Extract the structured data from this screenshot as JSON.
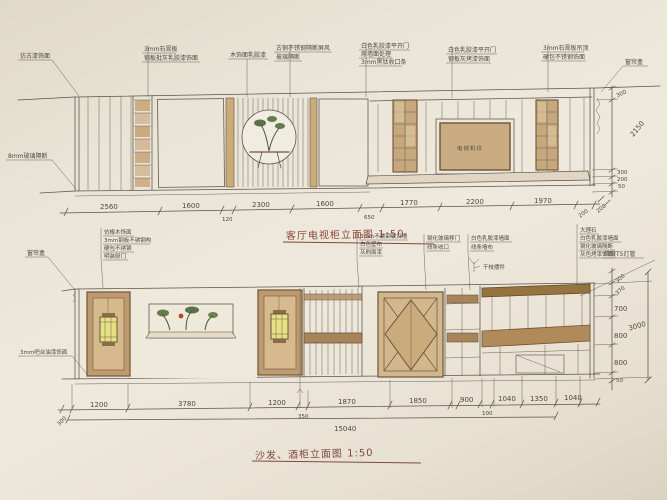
{
  "colors": {
    "paper": "#eae4d6",
    "ink": "#5a5348",
    "wood_dark": "#6e5439",
    "wood_fill": "#bd9a6f",
    "wood_light": "#d6ba8e",
    "tan": "#c9ab7c",
    "shelf_brown": "#a8845a",
    "lamp_yellow": "#e7e084",
    "plant_green": "#3f5c2e",
    "title_red": "#8a4536"
  },
  "top": {
    "title": "客厅电视柜立面图 1:50",
    "tv_label": "电视机位",
    "ann": {
      "a1": "仿古漆饰面",
      "a2a": "3mm石膏板",
      "a2b": "钢板批灰乳胶漆饰面",
      "a3": "木饰面乳胶漆",
      "a4a": "古铜不锈钢隔断屏风",
      "a4b": "玻璃隔断",
      "a5a": "白色乳胶漆平开门",
      "a5b": "原墙面处理",
      "a5c": "3mm黑钛收口条",
      "a6a": "白色乳胶漆平开门",
      "a6b": "钢板灰烤漆饰面",
      "a7a": "3mm石膏板吊顶",
      "a7b": "硬包不锈钢饰面",
      "a8": "窗帘盒"
    },
    "dims": [
      "2560",
      "1600",
      "120",
      "2300",
      "1600",
      "650",
      "1770",
      "2200",
      "1970",
      "200"
    ],
    "vdims": [
      "300",
      "2150",
      "300",
      "200",
      "50",
      "200"
    ]
  },
  "mid": {
    "ga": [
      "仿橡木饰面",
      "3mm钢板不锈钢构",
      "硬包不锈钢",
      "明装厨门"
    ],
    "gb": [
      "3mm不锈钢收口槽",
      "白色壁布",
      "灰刷面漆"
    ],
    "gc1": [
      "钢化玻璃移门",
      "线条收口"
    ],
    "gc2": [
      "白色乳胶漆墙面",
      "线条墙布"
    ],
    "gd": [
      "大理石",
      "白色乳胶漆墙面",
      "钢化玻璃隔断",
      "灰色烤漆饰面"
    ],
    "t5": "暗藏T5灯管",
    "branch": "干枝摆件"
  },
  "left": {
    "glass": "8mm玻璃隔断",
    "curtain": "窗帘盒",
    "bar": "3mm吧台油漆饰面"
  },
  "bottom": {
    "title": "沙发、酒柜立面图 1:50",
    "dims": [
      "300",
      "1200",
      "3780",
      "1200",
      "350",
      "1870",
      "1850",
      "900",
      "100",
      "1040",
      "1350",
      "1040"
    ],
    "total": "15040",
    "vdims": [
      "300",
      "370",
      "700",
      "800",
      "800",
      "50",
      "3000"
    ]
  }
}
